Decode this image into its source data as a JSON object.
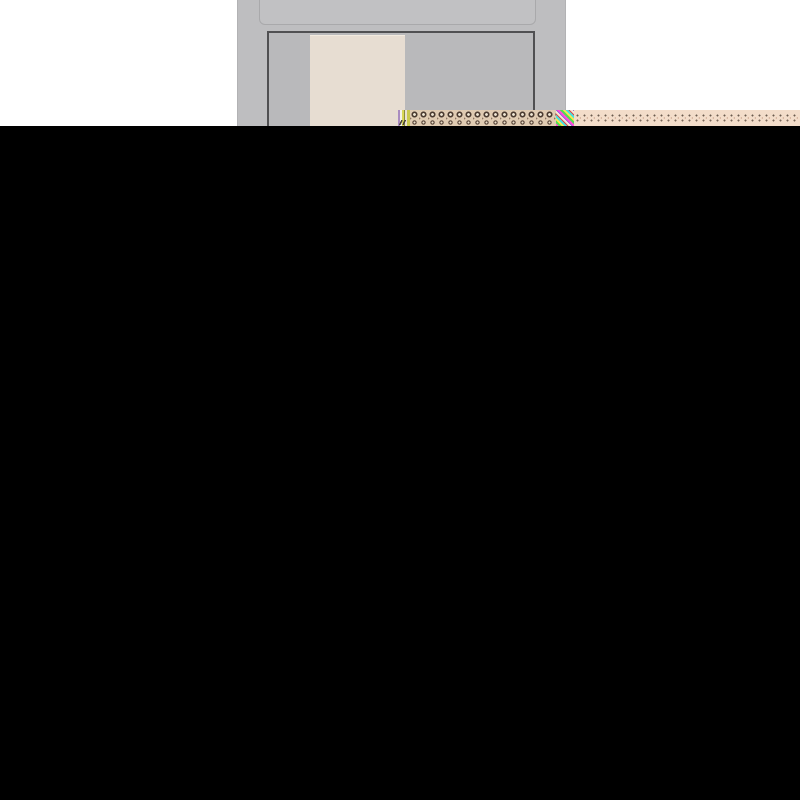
{
  "screen": {
    "description": "corrupted screenshot: partially rendered gray window on white band, glitch artifact strip, rest of screen black",
    "visible_text": [],
    "colors": {
      "black": "#000000",
      "white": "#ffffff",
      "window_gray": "#bebec0",
      "titlebar_gray": "#c1c1c3",
      "titlebar_border": "#a9a9ab",
      "frame_gray": "#b9b9bb",
      "frame_border": "#505052",
      "canvas_beige": "#e7ddd2",
      "canvas_highlight": "#f2eadf",
      "glitch_knot_base": "#e0cbb2",
      "glitch_knot_dark": "#4a3a30",
      "glitch_dots_base": "#f3ddca",
      "glitch_dots_dark": "#6a5a4e",
      "glitch_line_yellow": "#d8d855",
      "glitch_line_purple": "#a98cc0",
      "glitch_noise_magenta": "#ff4fd8",
      "glitch_noise_green": "#52e052",
      "glitch_noise_cyan": "#4ae0e0"
    },
    "regions": {
      "top_band": {
        "x": 0,
        "y": 0,
        "w": 800,
        "h": 126
      },
      "app_window": {
        "x": 237,
        "y": 0,
        "w": 329,
        "h": 126
      },
      "titlebar": {
        "x": 259,
        "y": 0,
        "w": 277,
        "h": 25
      },
      "content_frame": {
        "x": 267,
        "y": 31,
        "w": 268,
        "h": 95
      },
      "canvas_page": {
        "x": 310,
        "y": 33,
        "w": 95,
        "h": 93
      },
      "glitch_strip": {
        "x": 398,
        "y": 110,
        "w": 402,
        "h": 16
      },
      "black_region": {
        "x": 0,
        "y": 126,
        "w": 800,
        "h": 674
      }
    }
  }
}
